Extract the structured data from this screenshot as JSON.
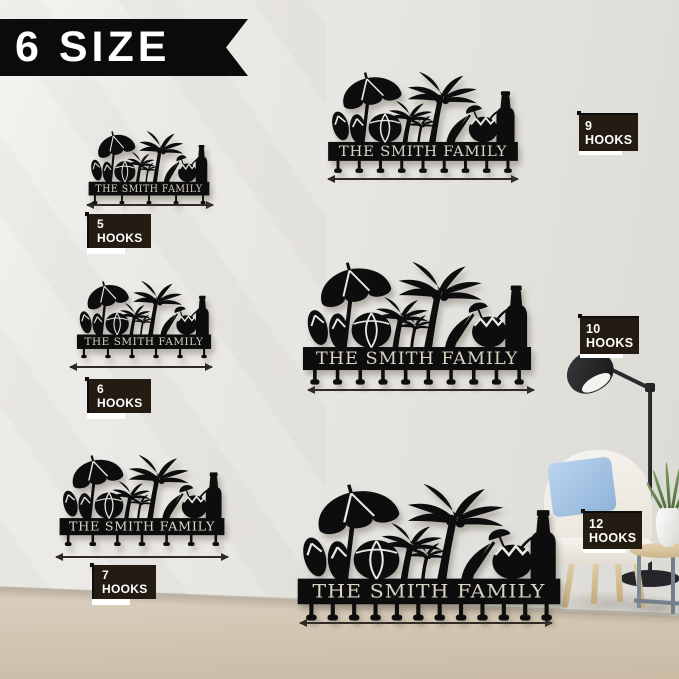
{
  "banner": {
    "text": "6 SIZE"
  },
  "product": {
    "name_text": "THE SMITH FAMILY"
  },
  "signs": [
    {
      "id": "10in",
      "size_label": "10 IN",
      "hooks_label": "5 HOOKS",
      "hooks_count": 5,
      "label_position": "below"
    },
    {
      "id": "12in",
      "size_label": "12 IN",
      "hooks_label": "6 HOOKS",
      "hooks_count": 6,
      "label_position": "below"
    },
    {
      "id": "15in",
      "size_label": "15 IN",
      "hooks_label": "7 HOOKS",
      "hooks_count": 7,
      "label_position": "below"
    },
    {
      "id": "18in",
      "size_label": "18 IN",
      "hooks_label": "9 HOOKS",
      "hooks_count": 9,
      "label_position": "right"
    },
    {
      "id": "20in",
      "size_label": "20 IN",
      "hooks_label": "10 HOOKS",
      "hooks_count": 10,
      "label_position": "right"
    },
    {
      "id": "24in",
      "size_label": "24 IN",
      "hooks_label": "12 HOOKS",
      "hooks_count": 12,
      "label_position": "right"
    }
  ],
  "colors": {
    "sign_black": "#0d0d0d",
    "banner_black": "#0b0b0b",
    "hooks_box_dark_brown": "#241b13",
    "sign_text_cream": "#d9d3c4",
    "wall_gray": "#e8e6e2",
    "floor_beige": "#d2c6b2",
    "pillow_blue": "#a4c4e4",
    "chair_cream": "#f2efe8",
    "plant_green": "#5f7f4b"
  },
  "scene_objects": [
    "floor-lamp",
    "armchair",
    "blue-pillow",
    "side-table",
    "vase-with-plant"
  ]
}
